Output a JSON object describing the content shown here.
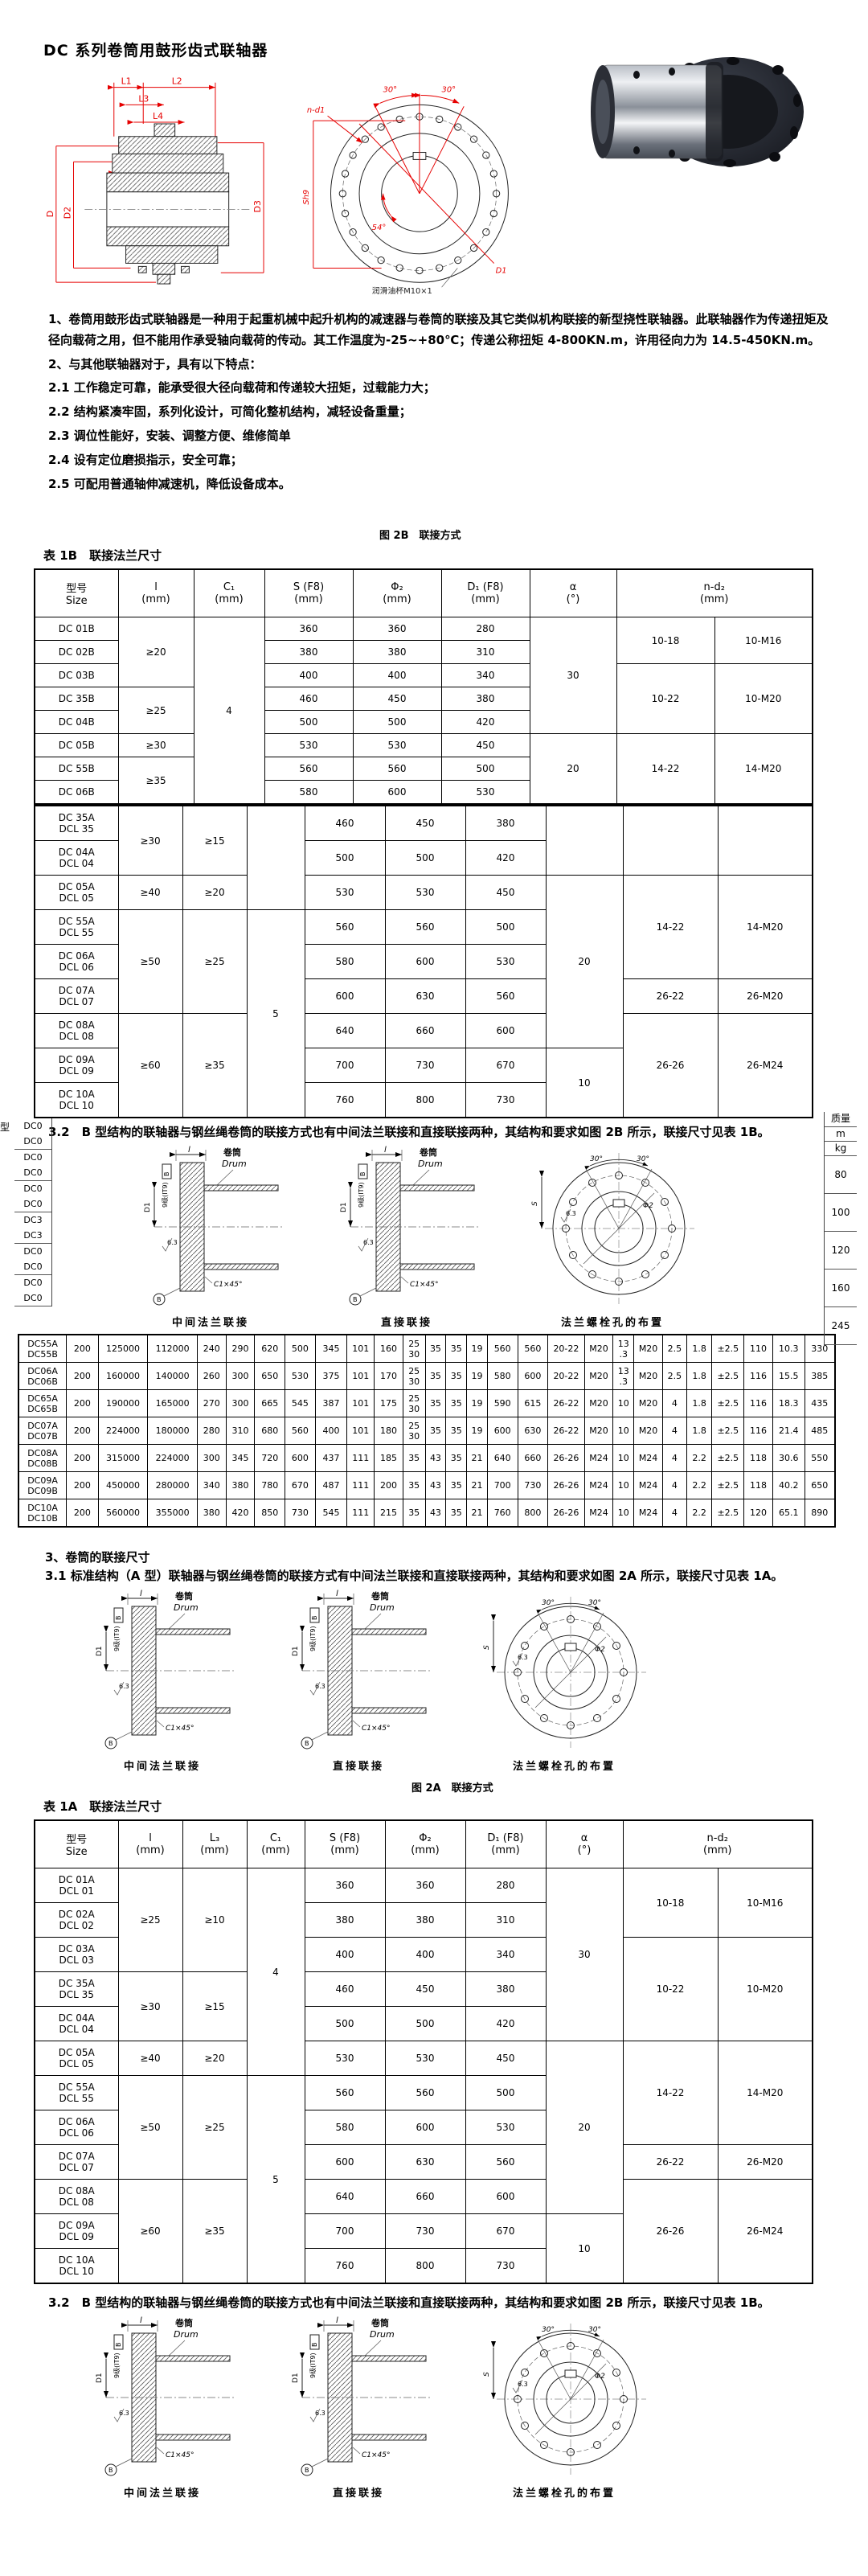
{
  "page_title": "DC 系列卷筒用鼓形齿式联轴器",
  "intro": {
    "p1": "1、卷筒用鼓形齿式联轴器是一种用于起重机械中起升机构的减速器与卷筒的联接及其它类似机构联接的新型挠性联轴器。此联轴器作为传递扭矩及径向载荷之用，但不能用作承受轴向载荷的传动。其工作温度为-25~+80℃；传递公称扭矩 4-800KN.m，许用径向力为 14.5-450KN.m。",
    "p2": "2、与其他联轴器对于，具有以下特点：",
    "p2_1": "2.1 工作稳定可靠，能承受很大径向载荷和传递较大扭矩，过载能力大；",
    "p2_2": "2.2 结构紧凑牢固，系列化设计，可简化整机结构，减轻设备重量；",
    "p2_3": "2.3 调位性能好，安装、调整方便、维修简单",
    "p2_4": "2.4 设有定位磨损指示，安全可靠；",
    "p2_5": "2.5 可配用普通轴伸减速机，降低设备成本。"
  },
  "figure_2b_caption": "图 2B　联接方式",
  "figure_2a_caption": "图 2A　联接方式",
  "section3": {
    "heading": "3、卷筒的联接尺寸",
    "p3_1": "3.1 标准结构（A 型）联轴器与钢丝绳卷筒的联接方式有中间法兰联接和直接联接两种，其结构和要求如图 2A 所示，联接尺寸见表 1A。",
    "p3_2": "3.2　B 型结构的联轴器与钢丝绳卷筒的联接方式也有中间法兰联接和直接联接两种，其结构和要求如图 2B 所示，联接尺寸见表 1B。"
  },
  "table_1b": {
    "title": "表 1B　联接法兰尺寸",
    "widths": [
      104,
      94,
      88,
      110,
      110,
      110,
      108,
      122,
      122
    ],
    "headers": [
      "型号\nSize",
      "l\n(mm)",
      "C₁\n(mm)",
      "S (F8)\n(mm)",
      "Φ₂\n(mm)",
      "D₁ (F8)\n(mm)",
      "α\n(°)",
      {
        "t": "n-d₂\n(mm)",
        "cs": 2
      }
    ],
    "rows": [
      [
        {
          "t": "DC 01B"
        },
        {
          "t": "≥20",
          "rs": 3
        },
        {
          "t": "4",
          "rs": 8
        },
        {
          "t": "360"
        },
        {
          "t": "360"
        },
        {
          "t": "280"
        },
        {
          "t": "30",
          "rs": 5
        },
        {
          "t": "10-18",
          "rs": 2
        },
        {
          "t": "10-M16",
          "rs": 2
        }
      ],
      [
        {
          "t": "DC 02B"
        },
        {
          "t": "380"
        },
        {
          "t": "380"
        },
        {
          "t": "310"
        }
      ],
      [
        {
          "t": "DC 03B"
        },
        {
          "t": "400"
        },
        {
          "t": "400"
        },
        {
          "t": "340"
        },
        {
          "t": "10-22",
          "rs": 3
        },
        {
          "t": "10-M20",
          "rs": 3
        }
      ],
      [
        {
          "t": "DC 35B"
        },
        {
          "t": "≥25",
          "rs": 2
        },
        {
          "t": "460"
        },
        {
          "t": "450"
        },
        {
          "t": "380"
        }
      ],
      [
        {
          "t": "DC 04B"
        },
        {
          "t": "500"
        },
        {
          "t": "500"
        },
        {
          "t": "420"
        }
      ],
      [
        {
          "t": "DC 05B"
        },
        {
          "t": "≥30"
        },
        {
          "t": "530"
        },
        {
          "t": "530"
        },
        {
          "t": "450"
        },
        {
          "t": "20",
          "rs": 3
        },
        {
          "t": "14-22",
          "rs": 3
        },
        {
          "t": "14-M20",
          "rs": 3
        }
      ],
      [
        {
          "t": "DC 55B"
        },
        {
          "t": "≥35",
          "rs": 2
        },
        {
          "t": "560"
        },
        {
          "t": "560"
        },
        {
          "t": "500"
        }
      ],
      [
        {
          "t": "DC 06B"
        },
        {
          "t": "580"
        },
        {
          "t": "600"
        },
        {
          "t": "530"
        }
      ]
    ]
  },
  "table_1b_cont": {
    "widths": [
      104,
      80,
      80,
      72,
      100,
      100,
      100,
      96,
      118,
      118
    ],
    "rows": [
      [
        {
          "t": "DC 35A\nDCL 35"
        },
        {
          "t": "≥30",
          "rs": 2
        },
        {
          "t": "≥15",
          "rs": 2
        },
        {
          "t": "",
          "rs": 3
        },
        {
          "t": "460"
        },
        {
          "t": "450"
        },
        {
          "t": "380"
        },
        {
          "t": "",
          "rs": 2
        },
        {
          "t": "",
          "rs": 2
        },
        {
          "t": "",
          "rs": 2
        }
      ],
      [
        {
          "t": "DC 04A\nDCL 04"
        },
        {
          "t": "500"
        },
        {
          "t": "500"
        },
        {
          "t": "420"
        }
      ],
      [
        {
          "t": "DC 05A\nDCL 05"
        },
        {
          "t": "≥40"
        },
        {
          "t": "≥20"
        },
        {
          "t": "530"
        },
        {
          "t": "530"
        },
        {
          "t": "450"
        },
        {
          "t": "20",
          "rs": 5
        },
        {
          "t": "14-22",
          "rs": 3
        },
        {
          "t": "14-M20",
          "rs": 3
        }
      ],
      [
        {
          "t": "DC 55A\nDCL 55"
        },
        {
          "t": "≥50",
          "rs": 3
        },
        {
          "t": "≥25",
          "rs": 3
        },
        {
          "t": "5",
          "rs": 6
        },
        {
          "t": "560"
        },
        {
          "t": "560"
        },
        {
          "t": "500"
        }
      ],
      [
        {
          "t": "DC 06A\nDCL 06"
        },
        {
          "t": "580"
        },
        {
          "t": "600"
        },
        {
          "t": "530"
        }
      ],
      [
        {
          "t": "DC 07A\nDCL 07"
        },
        {
          "t": "600"
        },
        {
          "t": "630"
        },
        {
          "t": "560"
        },
        {
          "t": "26-22"
        },
        {
          "t": "26-M20"
        }
      ],
      [
        {
          "t": "DC 08A\nDCL 08"
        },
        {
          "t": "≥60",
          "rs": 3
        },
        {
          "t": "≥35",
          "rs": 3
        },
        {
          "t": "640"
        },
        {
          "t": "660"
        },
        {
          "t": "600"
        },
        {
          "t": "26-26",
          "rs": 3
        },
        {
          "t": "26-M24",
          "rs": 3
        }
      ],
      [
        {
          "t": "DC 09A\nDCL 09"
        },
        {
          "t": "700"
        },
        {
          "t": "730"
        },
        {
          "t": "670"
        },
        {
          "t": "10",
          "rs": 2
        }
      ],
      [
        {
          "t": "DC 10A\nDCL 10"
        },
        {
          "t": "760"
        },
        {
          "t": "800"
        },
        {
          "t": "730"
        }
      ]
    ]
  },
  "edge_left": {
    "type_label": "型",
    "codes": [
      "DC0",
      "DC0",
      "DC0",
      "DC0",
      "DC0",
      "DC0",
      "DC3",
      "DC3",
      "DC0",
      "DC0",
      "DC0",
      "DC0"
    ]
  },
  "edge_right": {
    "mass_label": "质量",
    "unit_m": "m",
    "unit_kg": "kg",
    "values": [
      "80",
      "100",
      "120",
      "160",
      "245"
    ]
  },
  "big_table": {
    "widths": [
      60,
      40,
      62,
      62,
      36,
      36,
      38,
      38,
      40,
      34,
      36,
      28,
      26,
      26,
      26,
      38,
      38,
      46,
      36,
      26,
      36,
      30,
      32,
      40,
      36,
      40,
      38
    ],
    "rows": [
      [
        "DC55A\nDC55B",
        "200",
        "125000",
        "112000",
        "240",
        "290",
        "620",
        "500",
        "345",
        "101",
        "160",
        "25\n30",
        "35",
        "35",
        "19",
        "560",
        "560",
        "20-22",
        "M20",
        "13\n.3",
        "M20",
        "2.5",
        "1.8",
        "±2.5",
        "110",
        "10.3",
        "330"
      ],
      [
        "DC06A\nDC06B",
        "200",
        "160000",
        "140000",
        "260",
        "300",
        "650",
        "530",
        "375",
        "101",
        "170",
        "25\n30",
        "35",
        "35",
        "19",
        "580",
        "600",
        "20-22",
        "M20",
        "13\n.3",
        "M20",
        "2.5",
        "1.8",
        "±2.5",
        "116",
        "15.5",
        "385"
      ],
      [
        "DC65A\nDC65B",
        "200",
        "190000",
        "165000",
        "270",
        "300",
        "665",
        "545",
        "387",
        "101",
        "175",
        "25\n30",
        "35",
        "35",
        "19",
        "590",
        "615",
        "26-22",
        "M20",
        "10",
        "M20",
        "4",
        "1.8",
        "±2.5",
        "116",
        "18.3",
        "435"
      ],
      [
        "DC07A\nDC07B",
        "200",
        "224000",
        "180000",
        "280",
        "310",
        "680",
        "560",
        "400",
        "101",
        "180",
        "25\n30",
        "35",
        "35",
        "19",
        "600",
        "630",
        "26-22",
        "M20",
        "10",
        "M20",
        "4",
        "1.8",
        "±2.5",
        "116",
        "21.4",
        "485"
      ],
      [
        "DC08A\nDC08B",
        "200",
        "315000",
        "224000",
        "300",
        "345",
        "720",
        "600",
        "437",
        "111",
        "185",
        "35",
        "43",
        "35",
        "21",
        "640",
        "660",
        "26-26",
        "M24",
        "10",
        "M24",
        "4",
        "2.2",
        "±2.5",
        "118",
        "30.6",
        "550"
      ],
      [
        "DC09A\nDC09B",
        "200",
        "450000",
        "280000",
        "340",
        "380",
        "780",
        "670",
        "487",
        "111",
        "200",
        "35",
        "43",
        "35",
        "21",
        "700",
        "730",
        "26-26",
        "M24",
        "10",
        "M24",
        "4",
        "2.2",
        "±2.5",
        "118",
        "40.2",
        "650"
      ],
      [
        "DC10A\nDC10B",
        "200",
        "560000",
        "355000",
        "380",
        "420",
        "850",
        "730",
        "545",
        "111",
        "215",
        "35",
        "43",
        "35",
        "21",
        "760",
        "800",
        "26-26",
        "M24",
        "10",
        "M24",
        "4",
        "2.2",
        "±2.5",
        "120",
        "65.1",
        "890"
      ]
    ]
  },
  "table_1a": {
    "title": "表 1A　联接法兰尺寸",
    "widths": [
      104,
      80,
      80,
      72,
      100,
      100,
      100,
      96,
      118,
      118
    ],
    "headers": [
      "型号\nSize",
      "l\n(mm)",
      "L₃\n(mm)",
      "C₁\n(mm)",
      "S (F8)\n(mm)",
      "Φ₂\n(mm)",
      "D₁ (F8)\n(mm)",
      "α\n(°)",
      {
        "t": "n-d₂\n(mm)",
        "cs": 2
      }
    ],
    "rows": [
      [
        {
          "t": "DC 01A\nDCL 01"
        },
        {
          "t": "≥25",
          "rs": 3
        },
        {
          "t": "≥10",
          "rs": 3
        },
        {
          "t": "4",
          "rs": 6
        },
        {
          "t": "360"
        },
        {
          "t": "360"
        },
        {
          "t": "280"
        },
        {
          "t": "30",
          "rs": 5
        },
        {
          "t": "10-18",
          "rs": 2
        },
        {
          "t": "10-M16",
          "rs": 2
        }
      ],
      [
        {
          "t": "DC 02A\nDCL 02"
        },
        {
          "t": "380"
        },
        {
          "t": "380"
        },
        {
          "t": "310"
        }
      ],
      [
        {
          "t": "DC 03A\nDCL 03"
        },
        {
          "t": "400"
        },
        {
          "t": "400"
        },
        {
          "t": "340"
        },
        {
          "t": "10-22",
          "rs": 3
        },
        {
          "t": "10-M20",
          "rs": 3
        }
      ],
      [
        {
          "t": "DC 35A\nDCL 35"
        },
        {
          "t": "≥30",
          "rs": 2
        },
        {
          "t": "≥15",
          "rs": 2
        },
        {
          "t": "460"
        },
        {
          "t": "450"
        },
        {
          "t": "380"
        }
      ],
      [
        {
          "t": "DC 04A\nDCL 04"
        },
        {
          "t": "500"
        },
        {
          "t": "500"
        },
        {
          "t": "420"
        }
      ],
      [
        {
          "t": "DC 05A\nDCL 05"
        },
        {
          "t": "≥40"
        },
        {
          "t": "≥20"
        },
        {
          "t": "530"
        },
        {
          "t": "530"
        },
        {
          "t": "450"
        },
        {
          "t": "20",
          "rs": 5
        },
        {
          "t": "14-22",
          "rs": 3
        },
        {
          "t": "14-M20",
          "rs": 3
        }
      ],
      [
        {
          "t": "DC 55A\nDCL 55"
        },
        {
          "t": "≥50",
          "rs": 3
        },
        {
          "t": "≥25",
          "rs": 3
        },
        {
          "t": "5",
          "rs": 6
        },
        {
          "t": "560"
        },
        {
          "t": "560"
        },
        {
          "t": "500"
        }
      ],
      [
        {
          "t": "DC 06A\nDCL 06"
        },
        {
          "t": "580"
        },
        {
          "t": "600"
        },
        {
          "t": "530"
        }
      ],
      [
        {
          "t": "DC 07A\nDCL 07"
        },
        {
          "t": "600"
        },
        {
          "t": "630"
        },
        {
          "t": "560"
        },
        {
          "t": "26-22"
        },
        {
          "t": "26-M20"
        }
      ],
      [
        {
          "t": "DC 08A\nDCL 08"
        },
        {
          "t": "≥60",
          "rs": 3
        },
        {
          "t": "≥35",
          "rs": 3
        },
        {
          "t": "640"
        },
        {
          "t": "660"
        },
        {
          "t": "600"
        },
        {
          "t": "26-26",
          "rs": 3
        },
        {
          "t": "26-M24",
          "rs": 3
        }
      ],
      [
        {
          "t": "DC 09A\nDCL 09"
        },
        {
          "t": "700"
        },
        {
          "t": "730"
        },
        {
          "t": "670"
        },
        {
          "t": "10",
          "rs": 2
        }
      ],
      [
        {
          "t": "DC 10A\nDCL 10"
        },
        {
          "t": "760"
        },
        {
          "t": "800"
        },
        {
          "t": "730"
        }
      ]
    ]
  },
  "diag": {
    "dim_l": "l",
    "drum_cn": "卷筒",
    "drum_en": "Drum",
    "grade": "9级(IT9)",
    "datum": "B",
    "d1": "D1",
    "rough": "6.3",
    "chamfer": "C1×45°",
    "a30": "30°",
    "phi2": "Φ2",
    "s_dim": "S",
    "cap1": "中间法兰联接",
    "cap2": "直接联接",
    "cap3": "法兰螺栓孔的布置"
  },
  "top_drawing": {
    "l1": "L1",
    "l2": "L2",
    "l3": "L3",
    "l4": "L4",
    "e": "e",
    "d": "D",
    "d2": "D2",
    "d3": "D3",
    "n_d1": "n-d1",
    "a30l": "30°",
    "a30r": "30°",
    "sh9": "Sh9",
    "a54": "54°",
    "d1": "D1",
    "lube": "润滑油杯M10×1"
  },
  "colors": {
    "dimension_red": "#e60000",
    "line_black": "#222222"
  }
}
